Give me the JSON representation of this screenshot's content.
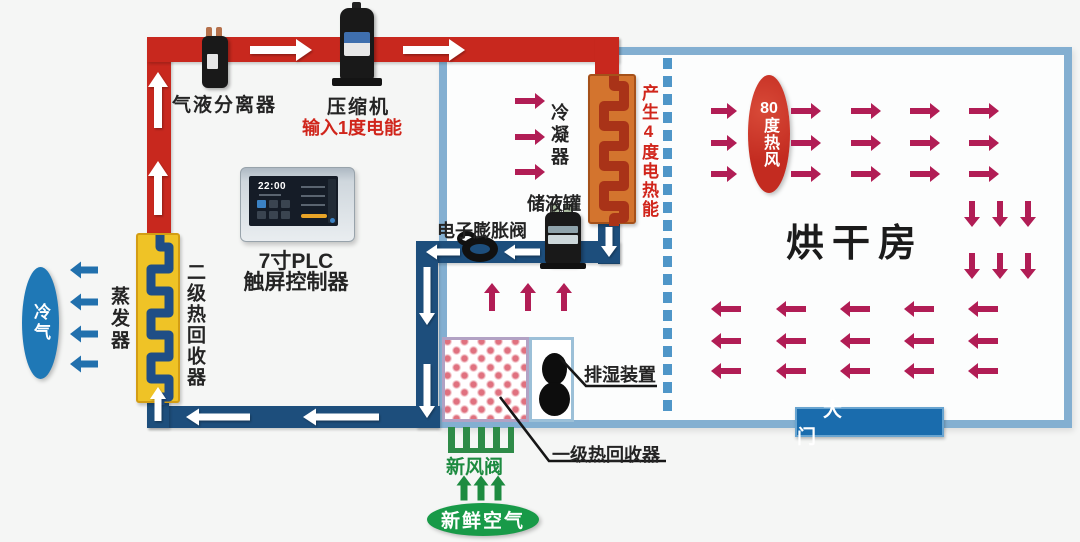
{
  "labels": {
    "separator": "气液分离器",
    "compressor": "压缩机",
    "power_input": "输入1度电能",
    "plc_line1": "7寸PLC",
    "plc_line2": "触屏控制器",
    "plc_time": "22:00",
    "condenser": "冷凝器",
    "heat_output": "产生4度电热能",
    "receiver": "储液罐",
    "expansion_valve": "电子膨胀阀",
    "evaporator": "蒸发器",
    "secondary_heat_recovery": "二级热回收器",
    "cold_air": "冷气",
    "hot_air_num": "80",
    "hot_air_rest": "度热风",
    "drying_room": "烘干房",
    "dehumidifier": "排湿装置",
    "primary_heat_recovery": "一级热回收器",
    "fresh_air_valve": "新风阀",
    "fresh_air": "新鲜空气",
    "door": "大 门"
  },
  "colors": {
    "pipe_hot": "#c8281e",
    "pipe_cold": "#1d4e7c",
    "room_border": "#83afd1",
    "hot_air_arrow": "#b11d55",
    "cold_air_arrow": "#2170ad",
    "fresh_air_arrow": "#1d8b40",
    "cold_ellipse": "#1f78b6",
    "hot_ellipse": "#c32b20",
    "fresh_ellipse": "#189a48",
    "door_banner": "#1a6cad",
    "accent_red_text": "#d0251b"
  },
  "arrow_groups": [
    {
      "name": "pipe-flow-white",
      "color": "#ffffff",
      "shadow": true,
      "defaults": {
        "t": 7,
        "hw": 16,
        "hl": 12
      },
      "items": [
        [
          281,
          50,
          "right",
          62,
          8,
          22,
          16
        ],
        [
          434,
          50,
          "right",
          62,
          8,
          22,
          16
        ],
        [
          158,
          100,
          "up",
          56,
          8,
          20,
          15
        ],
        [
          158,
          188,
          "up",
          54,
          8,
          20,
          15
        ],
        [
          609,
          242,
          "down",
          30,
          7,
          16,
          11
        ],
        [
          522,
          252,
          "left",
          36,
          7,
          15,
          11
        ],
        [
          443,
          252,
          "left",
          34,
          7,
          15,
          11
        ],
        [
          427,
          296,
          "down",
          58,
          7,
          16,
          12
        ],
        [
          427,
          391,
          "down",
          54,
          7,
          16,
          12
        ],
        [
          341,
          417,
          "left",
          76,
          7,
          17,
          13
        ],
        [
          218,
          417,
          "left",
          64,
          7,
          17,
          13
        ],
        [
          158,
          404,
          "up",
          34,
          7,
          16,
          12
        ]
      ]
    },
    {
      "name": "hot-air-flow",
      "color": "#b11d55",
      "defaults": {
        "t": 6,
        "hw": 16,
        "hl": 10
      },
      "items": [
        [
          530,
          101,
          "right",
          30
        ],
        [
          530,
          137,
          "right",
          30
        ],
        [
          530,
          172,
          "right",
          30
        ],
        [
          492,
          297,
          "up",
          28
        ],
        [
          528,
          297,
          "up",
          28
        ],
        [
          564,
          297,
          "up",
          28
        ],
        [
          724,
          111,
          "right",
          26
        ],
        [
          724,
          143,
          "right",
          26
        ],
        [
          724,
          174,
          "right",
          26
        ],
        [
          806,
          111,
          "right",
          30
        ],
        [
          806,
          143,
          "right",
          30
        ],
        [
          806,
          174,
          "right",
          30
        ],
        [
          866,
          111,
          "right",
          30
        ],
        [
          866,
          143,
          "right",
          30
        ],
        [
          866,
          174,
          "right",
          30
        ],
        [
          925,
          111,
          "right",
          30
        ],
        [
          925,
          143,
          "right",
          30
        ],
        [
          925,
          174,
          "right",
          30
        ],
        [
          984,
          111,
          "right",
          30
        ],
        [
          984,
          143,
          "right",
          30
        ],
        [
          984,
          174,
          "right",
          30
        ],
        [
          972,
          214,
          "down",
          26
        ],
        [
          1000,
          214,
          "down",
          26
        ],
        [
          1028,
          214,
          "down",
          26
        ],
        [
          972,
          266,
          "down",
          26
        ],
        [
          1000,
          266,
          "down",
          26
        ],
        [
          1028,
          266,
          "down",
          26
        ],
        [
          726,
          309,
          "left",
          30
        ],
        [
          791,
          309,
          "left",
          30
        ],
        [
          855,
          309,
          "left",
          30
        ],
        [
          919,
          309,
          "left",
          30
        ],
        [
          983,
          309,
          "left",
          30
        ],
        [
          726,
          341,
          "left",
          30
        ],
        [
          791,
          341,
          "left",
          30
        ],
        [
          855,
          341,
          "left",
          30
        ],
        [
          919,
          341,
          "left",
          30
        ],
        [
          983,
          341,
          "left",
          30
        ],
        [
          726,
          371,
          "left",
          30
        ],
        [
          791,
          371,
          "left",
          30
        ],
        [
          855,
          371,
          "left",
          30
        ],
        [
          919,
          371,
          "left",
          30
        ],
        [
          983,
          371,
          "left",
          30
        ]
      ]
    },
    {
      "name": "cold-air-flow",
      "color": "#2170ad",
      "defaults": {
        "t": 7,
        "hw": 17,
        "hl": 11
      },
      "items": [
        [
          84,
          270,
          "left",
          28
        ],
        [
          84,
          302,
          "left",
          28
        ],
        [
          84,
          334,
          "left",
          28
        ],
        [
          84,
          364,
          "left",
          28
        ]
      ]
    },
    {
      "name": "fresh-air-flow",
      "color": "#1d8b40",
      "defaults": {
        "t": 7,
        "hw": 15,
        "hl": 10
      },
      "items": [
        [
          464,
          488,
          "up",
          25
        ],
        [
          481,
          488,
          "up",
          25
        ],
        [
          498,
          488,
          "up",
          25
        ]
      ]
    }
  ],
  "leader_lines": [
    [
      [
        560,
        358
      ],
      [
        586,
        386
      ],
      [
        657,
        386
      ]
    ],
    [
      [
        500,
        397
      ],
      [
        549,
        461
      ],
      [
        666,
        461
      ]
    ]
  ]
}
